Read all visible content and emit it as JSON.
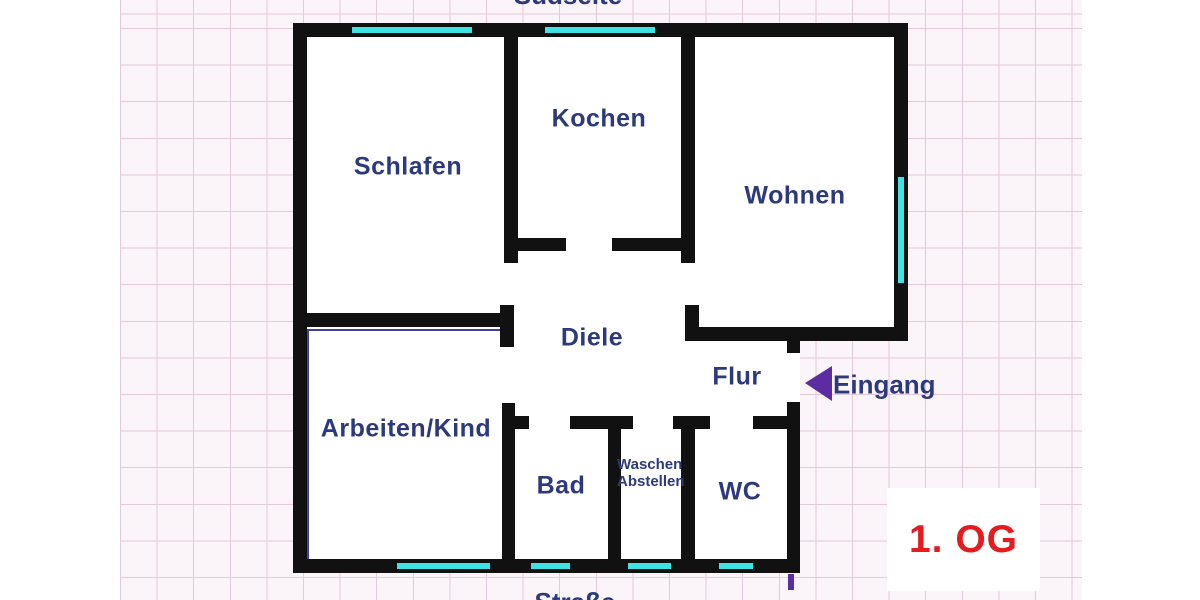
{
  "floor_plan": {
    "floor_label": "1. OG",
    "side_label_top": "Südseite",
    "side_label_bottom": "Straße",
    "entrance_label": "Eingang",
    "rooms": {
      "schlafen": {
        "label": "Schlafen"
      },
      "kochen": {
        "label": "Kochen"
      },
      "wohnen": {
        "label": "Wohnen"
      },
      "diele": {
        "label": "Diele"
      },
      "flur": {
        "label": "Flur"
      },
      "arbeiten_kind": {
        "label": "Arbeiten/Kind"
      },
      "bad": {
        "label": "Bad"
      },
      "waschen_abstellen": {
        "label_line1": "Waschen",
        "label_line2": "Abstellen"
      },
      "wc": {
        "label": "WC"
      }
    },
    "colors": {
      "wall": "#111111",
      "window_marker": "#3fe3e3",
      "room_label": "#2c3a7d",
      "entrance_arrow": "#5b2da1",
      "floor_label": "#e51b1e",
      "paper": "#fbf4f9",
      "grid_line": "#e3c9d9"
    }
  }
}
